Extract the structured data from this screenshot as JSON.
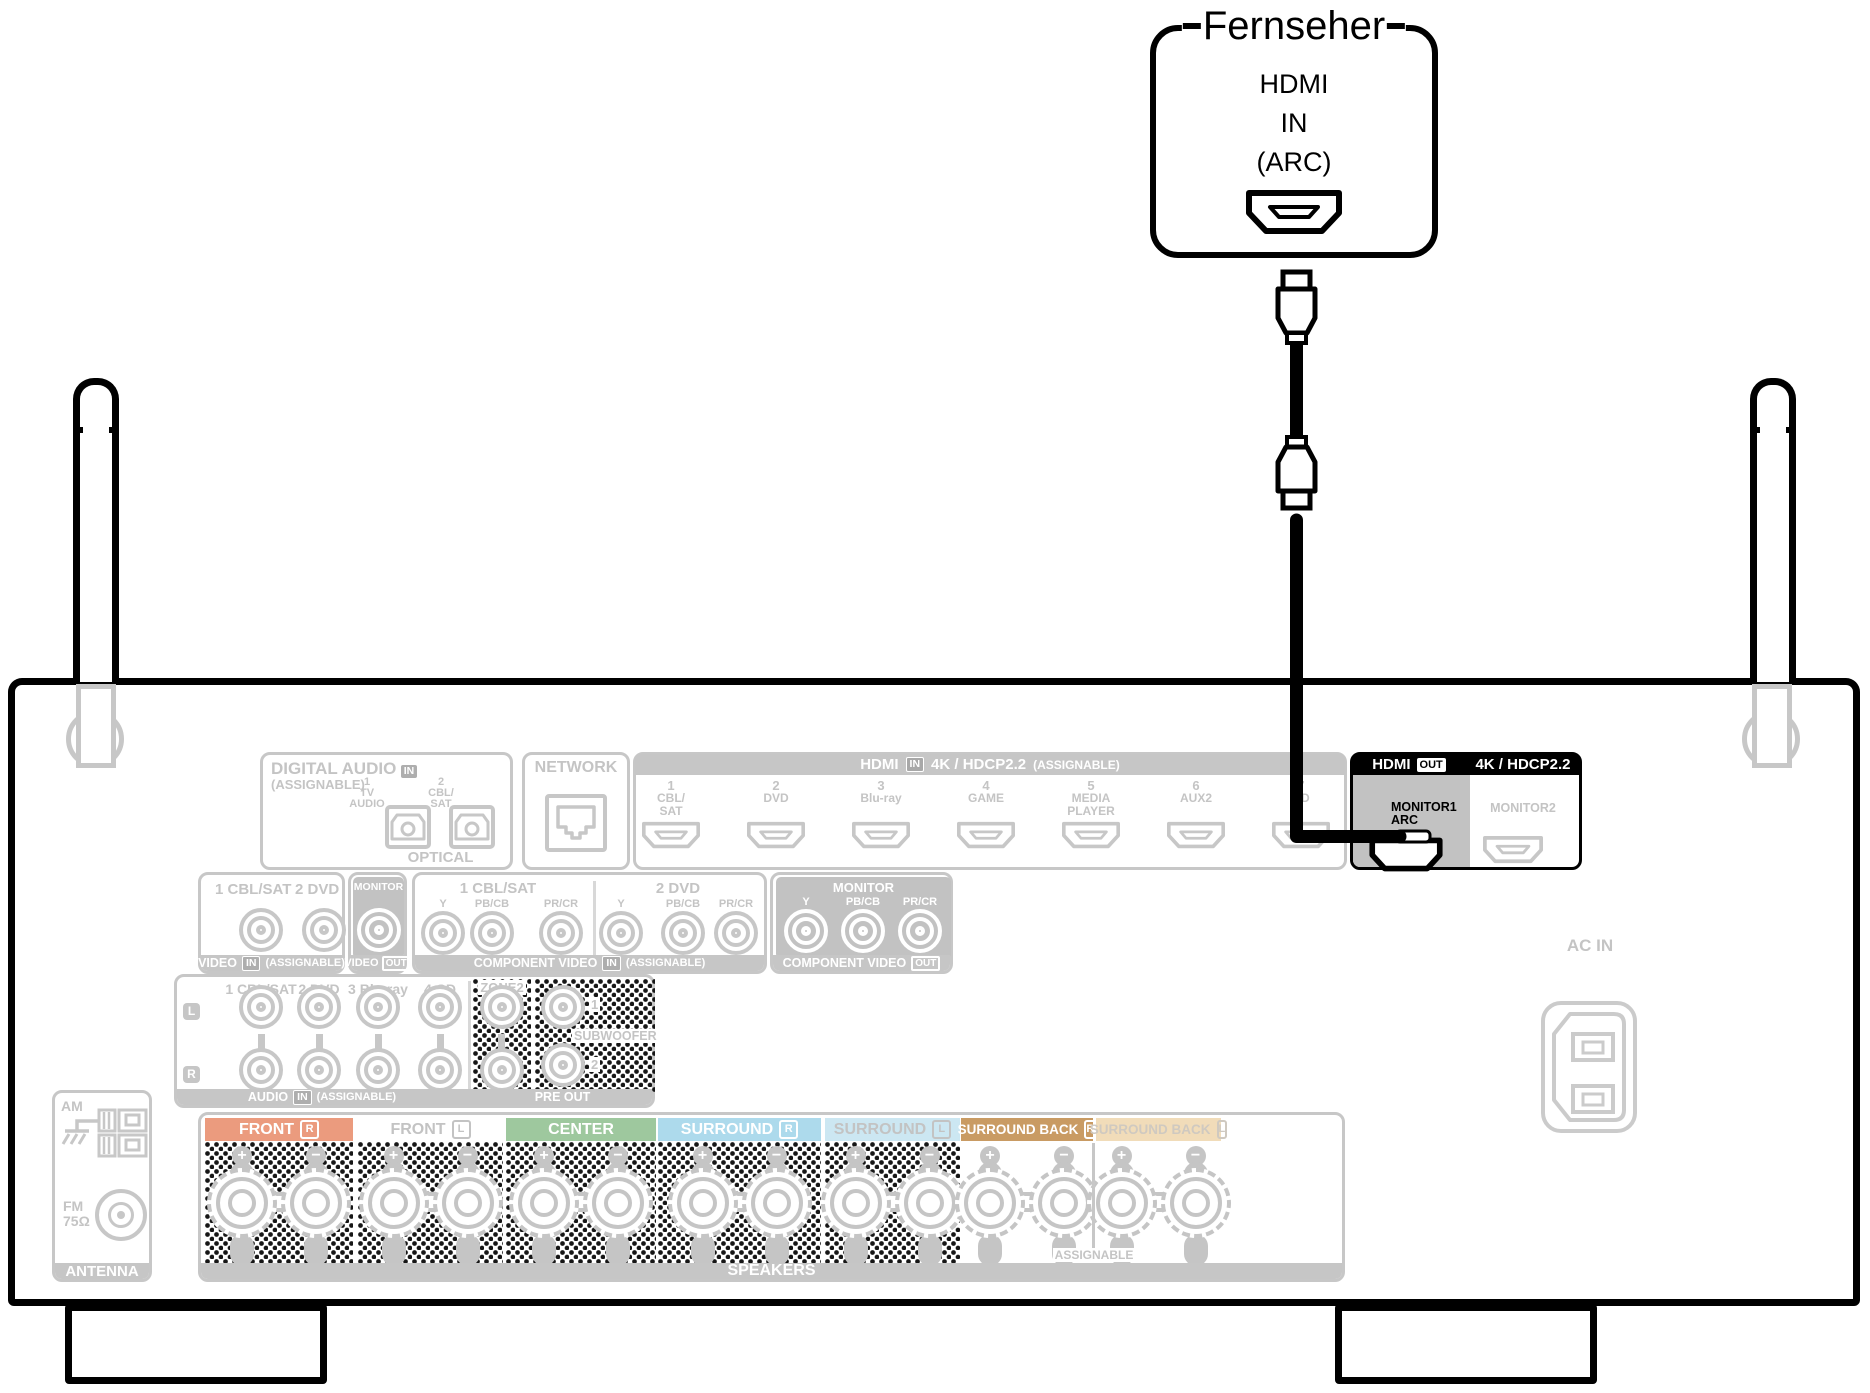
{
  "tv": {
    "title": "Fernseher",
    "line1": "HDMI",
    "line2": "IN",
    "line3": "(ARC)"
  },
  "rear_panel": {
    "digital_audio": {
      "title": "DIGITAL AUDIO",
      "in_badge": "IN",
      "assignable": "(ASSIGNABLE)",
      "port1_num": "1",
      "port1_a": "TV",
      "port1_b": "AUDIO",
      "port2_num": "2",
      "port2_a": "CBL/",
      "port2_b": "SAT",
      "optical": "OPTICAL"
    },
    "network": {
      "title": "NETWORK"
    },
    "hdmi_in": {
      "title": "HDMI",
      "in_badge": "IN",
      "spec": "4K / HDCP2.2",
      "assignable": "(ASSIGNABLE)",
      "inputs": [
        {
          "num": "1",
          "a": "CBL/",
          "b": "SAT"
        },
        {
          "num": "2",
          "a": "DVD",
          "b": ""
        },
        {
          "num": "3",
          "a": "Blu-ray",
          "b": ""
        },
        {
          "num": "4",
          "a": "GAME",
          "b": ""
        },
        {
          "num": "5",
          "a": "MEDIA",
          "b": "PLAYER"
        },
        {
          "num": "6",
          "a": "AUX2",
          "b": ""
        },
        {
          "num": "7",
          "a": "CD",
          "b": ""
        }
      ]
    },
    "hdmi_out": {
      "title": "HDMI",
      "out_badge": "OUT",
      "spec": "4K / HDCP2.2",
      "monitor1": "MONITOR1",
      "arc": "ARC",
      "monitor2": "MONITOR2"
    },
    "video_in": {
      "label1": "1 CBL/SAT",
      "label2": "2 DVD",
      "footer": "VIDEO",
      "in_badge": "IN",
      "assignable": "(ASSIGNABLE)"
    },
    "video_out": {
      "label": "MONITOR",
      "footer": "VIDEO",
      "out_badge": "OUT"
    },
    "comp_in": {
      "group1": "1 CBL/SAT",
      "group2": "2 DVD",
      "y": "Y",
      "pb": "PB/CB",
      "pr": "PR/CR",
      "footer": "COMPONENT VIDEO",
      "in_badge": "IN",
      "assignable": "(ASSIGNABLE)"
    },
    "comp_out": {
      "label": "MONITOR",
      "y": "Y",
      "pb": "PB/CB",
      "pr": "PR/CR",
      "footer": "COMPONENT VIDEO",
      "out_badge": "OUT"
    },
    "audio_in": {
      "label1": "1 CBL/SAT",
      "label2": "2 DVD",
      "label3": "3 Blu-ray",
      "label4": "4 CD",
      "left": "L",
      "right": "R",
      "footer": "AUDIO",
      "in_badge": "IN",
      "assignable": "(ASSIGNABLE)"
    },
    "pre_out": {
      "zone2": "ZONE2",
      "subwoofer": "SUBWOOFER",
      "sub1": "1",
      "sub2": "2",
      "footer": "PRE OUT"
    },
    "speakers": {
      "footer": "SPEAKERS",
      "assignable": "ASSIGNABLE",
      "plus": "+",
      "minus": "−",
      "sections": [
        {
          "label": "FRONT",
          "channel": "R",
          "bg": "#eb9b7e",
          "fg": "#ffffff"
        },
        {
          "label": "FRONT",
          "channel": "L",
          "bg": "transparent",
          "fg": "#c3c3c3"
        },
        {
          "label": "CENTER",
          "channel": "",
          "bg": "#9ec89e",
          "fg": "#ffffff"
        },
        {
          "label": "SURROUND",
          "channel": "R",
          "bg": "#addaec",
          "fg": "#ffffff"
        },
        {
          "label": "SURROUND",
          "channel": "L",
          "bg": "#cce7f2",
          "fg": "#c3c3c3"
        },
        {
          "label": "SURROUND BACK",
          "channel": "R",
          "bg": "#c99b63",
          "fg": "#ffffff"
        },
        {
          "label": "SURROUND BACK",
          "channel": "L",
          "bg": "#f1dcb9",
          "fg": "#cfc9c0"
        }
      ]
    },
    "antenna": {
      "am": "AM",
      "fm": "FM",
      "ohm": "75Ω",
      "footer": "ANTENNA"
    },
    "ac_in": {
      "label": "AC IN"
    }
  }
}
